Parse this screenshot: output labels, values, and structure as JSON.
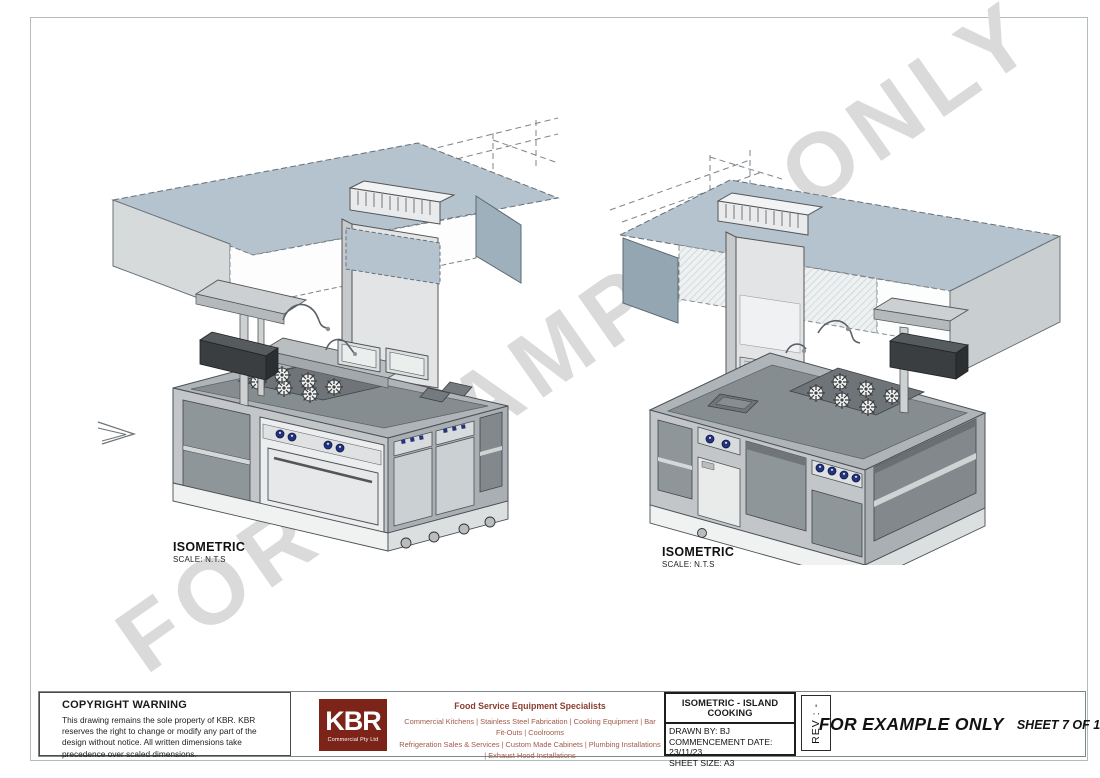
{
  "page": {
    "watermark": "FOR EXAMPLE ONLY"
  },
  "views": {
    "left": {
      "title": "ISOMETRIC",
      "scale": "SCALE: N.T.S"
    },
    "right": {
      "title": "ISOMETRIC",
      "scale": "SCALE: N.T.S"
    }
  },
  "title_block": {
    "copyright": {
      "heading": "COPYRIGHT WARNING",
      "body": "This drawing remains the sole property of KBR.  KBR reserves the right to change or modify any part of the design without notice.  All written dimensions take precedence over scaled dimensions."
    },
    "logo": {
      "name": "KBR",
      "subtitle": "Commercial Pty Ltd"
    },
    "services": {
      "heading": "Food Service Equipment Specialists",
      "line1": "Commercial Kitchens   |   Stainless Steel Fabrication   |   Cooking Equipment   |   Bar Fit-Outs   |   Coolrooms",
      "line2": "Refrigeration Sales & Services   |   Custom Made Cabinets   |   Plumbing Installations   |   Exhaust Hood Installations"
    },
    "drawing_info": {
      "title": "ISOMETRIC - ISLAND COOKING",
      "drawn_by": "DRAWN BY: BJ",
      "commencement": "COMMENCEMENT DATE: 23/11/23",
      "sheet_size": "SHEET SIZE: A3"
    },
    "rev": "REV : -",
    "example_only": "FOR EXAMPLE ONLY",
    "sheet": "SHEET 7 OF 10"
  },
  "colors": {
    "brand_red": "#7c241a",
    "services_text": "#a05a48",
    "watermark_gray": "#dadada",
    "canopy_blue": "#b5c3ce",
    "panel_dark": "#93a6b1",
    "island_top": "#aeb4b7",
    "knob_navy": "#24337d",
    "outline": "#41464a"
  }
}
